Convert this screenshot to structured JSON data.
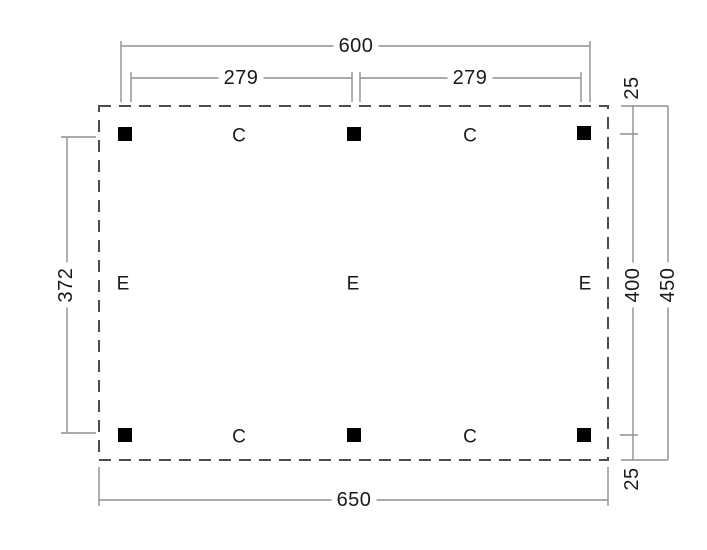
{
  "colors": {
    "background": "#ffffff",
    "dimension_lines": "#8f8f8f",
    "outline_dashed": "#4c4c4c",
    "posts": "#000000",
    "text": "#1a1a1a"
  },
  "dimensions": {
    "top_total": "600",
    "top_bay_left": "279",
    "top_bay_right": "279",
    "left_post_span": "372",
    "right_top_offset": "25",
    "right_post_span": "400",
    "right_total": "450",
    "right_bottom_offset": "25",
    "bottom_total": "650"
  },
  "post_labels": {
    "top": [
      "C",
      "C"
    ],
    "middle": [
      "E",
      "E",
      "E"
    ],
    "bottom": [
      "C",
      "C"
    ]
  }
}
